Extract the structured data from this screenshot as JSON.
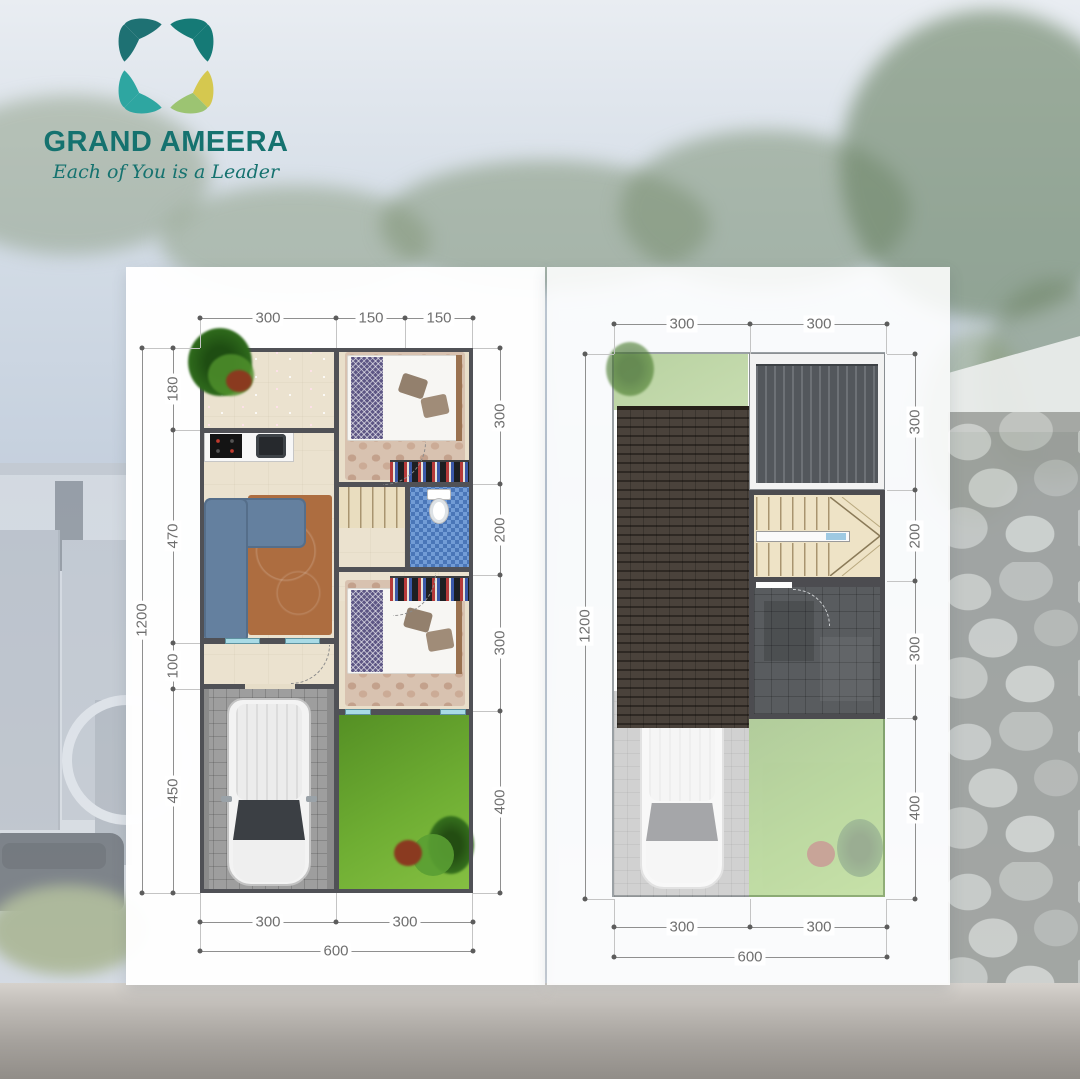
{
  "brand": {
    "name": "GRAND AMEERA",
    "tagline": "Each of You is a Leader"
  },
  "ground_plan": {
    "top_dims": [
      "300",
      "150",
      "150"
    ],
    "left_total": "1200",
    "left_inner_dims": [
      "180",
      "470",
      "100",
      "450"
    ],
    "right_dims": [
      "300",
      "200",
      "300",
      "400"
    ],
    "bottom_dims": [
      "300",
      "300"
    ],
    "bottom_total": "600"
  },
  "upper_plan": {
    "top_dims": [
      "300",
      "300"
    ],
    "left_total": "1200",
    "right_dims": [
      "300",
      "200",
      "300",
      "400"
    ],
    "bottom_dims": [
      "300",
      "300"
    ],
    "bottom_total": "600"
  },
  "colors": {
    "brand_teal": "#15726F",
    "logo_teal_dark": "#1E7173",
    "logo_teal": "#157A76",
    "logo_cyan": "#2EA6A1",
    "logo_yellow": "#D5C84F",
    "logo_green": "#9CC472"
  }
}
